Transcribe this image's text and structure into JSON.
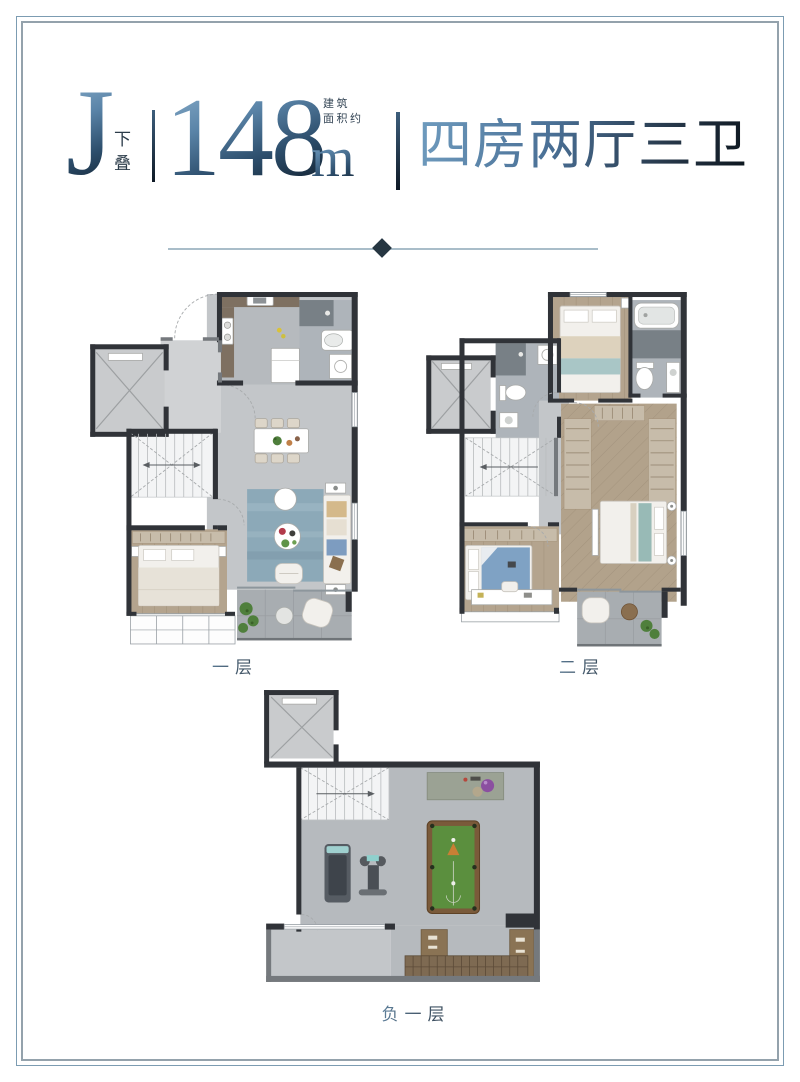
{
  "header": {
    "unit_letter": "J",
    "unit_type_vertical": "下叠",
    "area_prefix_line1": "建筑",
    "area_prefix_line2": "面积约",
    "area_value": "148",
    "area_unit": "m",
    "area_unit_exponent": "2",
    "layout_description": "四房两厅三卫"
  },
  "floor_labels": {
    "first": "一层",
    "second": "二层",
    "basement": "负一层"
  },
  "colors": {
    "accent_gradient_from": "#8db1cd",
    "accent_gradient_to": "#0d1823",
    "divider_line": "#a9bdc9",
    "divider_diamond": "#263642",
    "frame_outer": "#7c9cb2",
    "frame_inner": "#94a2ac",
    "plan_wall": "#303338",
    "plan_floor_tile": "#c3c6c9",
    "plan_wood_floor": "#b4a48e",
    "plan_rug_blue": "#8ca9b8",
    "plan_billiard_green": "#5b8f3e"
  }
}
